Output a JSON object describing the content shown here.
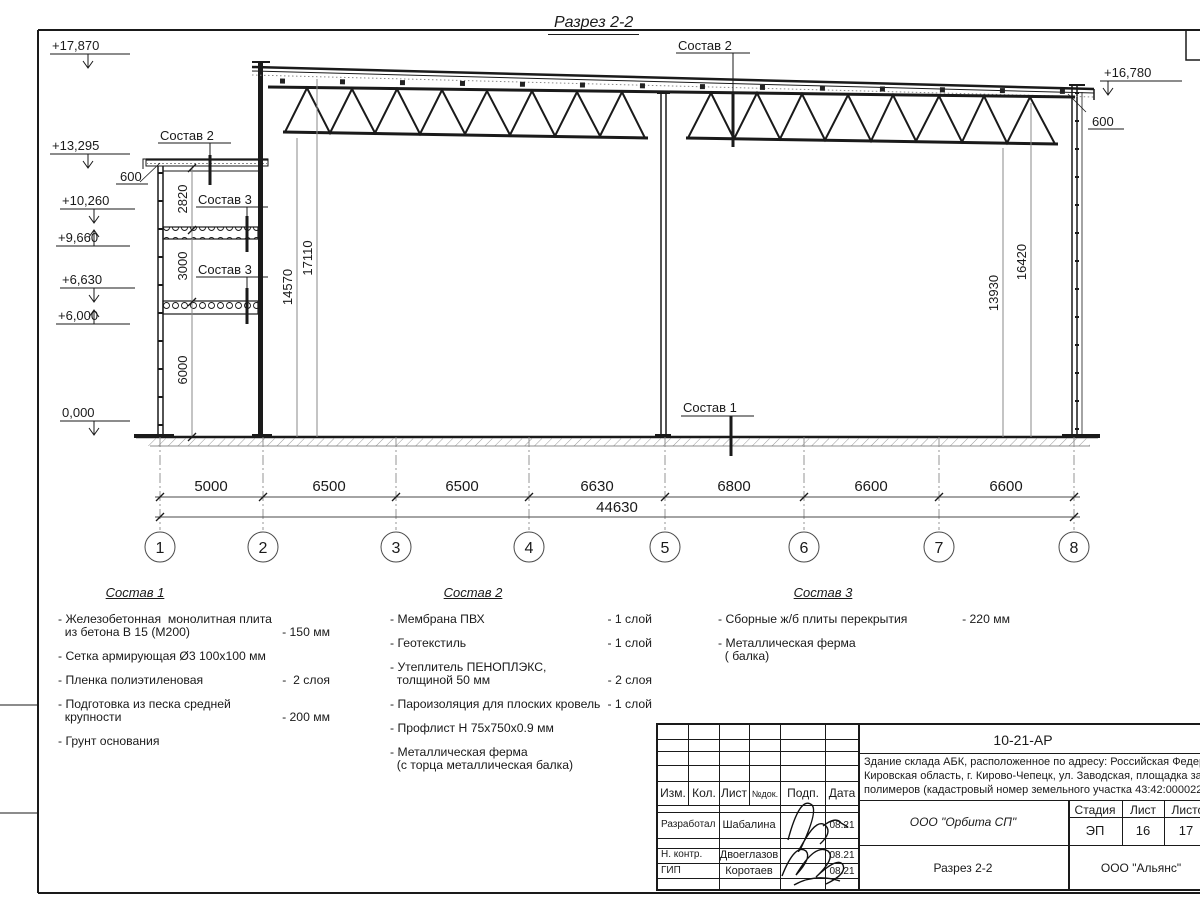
{
  "sheet": {
    "title": "Разрез 2-2",
    "elevations": {
      "e1": "+17,870",
      "e2": "+13,295",
      "e3": "+10,260",
      "e4": "+9,660",
      "e5": "+6,630",
      "e6": "+6,000",
      "e7": "0,000",
      "e8": "+16,780"
    },
    "dims": {
      "left600": "600",
      "right600": "600",
      "v2820": "2820",
      "v3000": "3000",
      "v6000": "6000",
      "v14570": "14570",
      "v17110": "17110",
      "v13930": "13930",
      "v16420": "16420"
    },
    "chain": {
      "s1": "5000",
      "s2": "6500",
      "s3": "6500",
      "s4": "6630",
      "s5": "6800",
      "s6": "6600",
      "s7": "6600",
      "total": "44630"
    },
    "grid": {
      "g1": "1",
      "g2": "2",
      "g3": "3",
      "g4": "4",
      "g5": "5",
      "g6": "6",
      "g7": "7",
      "g8": "8"
    },
    "leaders": {
      "roof": "Состав 2",
      "annex_roof": "Состав 2",
      "slab_upper": "Состав 3",
      "slab_lower": "Состав 3",
      "floor": "Состав 1"
    }
  },
  "lists": {
    "l1": {
      "title": "Состав 1",
      "items": [
        {
          "name": "- Железобетонная  монолитная плита\n  из бетона В 15 (М200)",
          "value": "- 150 мм"
        },
        {
          "name": "- Сетка армирующая Ø3 100х100 мм",
          "value": ""
        },
        {
          "name": "- Пленка полиэтиленовая",
          "value": "-  2 слоя"
        },
        {
          "name": "- Подготовка из песка средней\n  крупности",
          "value": "- 200 мм"
        },
        {
          "name": "- Грунт основания",
          "value": ""
        }
      ]
    },
    "l2": {
      "title": "Состав 2",
      "items": [
        {
          "name": "- Мембрана ПВХ",
          "value": "- 1 слой"
        },
        {
          "name": "- Геотекстиль",
          "value": "- 1 слой"
        },
        {
          "name": "- Утеплитель ПЕНОПЛЭКС,\n  толщиной 50 мм",
          "value": "- 2 слоя"
        },
        {
          "name": "- Пароизоляция для плоских кровель",
          "value": "- 1 слой"
        },
        {
          "name": "- Профлист Н 75х750х0.9 мм",
          "value": ""
        },
        {
          "name": "- Металлическая ферма\n  (с торца металлическая балка)",
          "value": ""
        }
      ]
    },
    "l3": {
      "title": "Состав 3",
      "items": [
        {
          "name": "- Сборные ж/б плиты перекрытия",
          "value": "- 220 мм"
        },
        {
          "name": "- Металлическая ферма\n  ( балка)",
          "value": ""
        }
      ]
    }
  },
  "stamp": {
    "doc_number": "10-21-АР",
    "address_line1": "Здание склада АБК, расположенное по адресу: Российская Федерация,",
    "address_line2": "Кировская область, г. Кирово-Чепецк, ул. Заводская, площадка завода",
    "address_line3": "полимеров (кадастровый номер земельного участка 43:42:000022:3",
    "cols": {
      "izm": "Изм.",
      "kol": "Кол.",
      "list": "Лист",
      "ndok": "№док.",
      "podp": "Подп.",
      "data": "Дата"
    },
    "rows": [
      {
        "role": "Разработал",
        "name": "Шабалина",
        "date": "08.21"
      },
      {
        "role": "Н. контр.",
        "name": "Двоеглазов",
        "date": "08.21"
      },
      {
        "role": "ГИП",
        "name": "Коротаев",
        "date": "08.21"
      }
    ],
    "stage_label": "Стадия",
    "sheet_label": "Лист",
    "sheets_label": "Листов",
    "stage": "ЭП",
    "sheet_no": "16",
    "sheets_total": "17",
    "org1": "ООО \"Орбита СП\"",
    "drawing_name": "Разрез 2-2",
    "org2": "ООО \"Альянс\""
  }
}
